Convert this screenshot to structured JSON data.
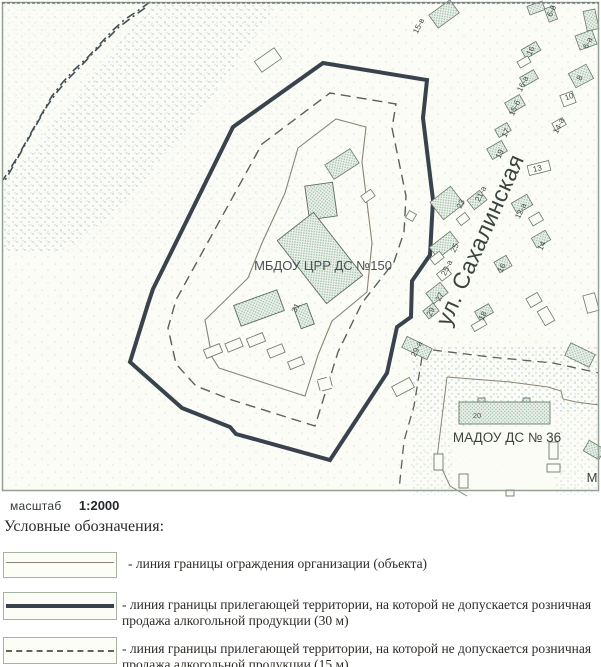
{
  "map": {
    "main_object_label": "МБДОУ ЦРР ДС №150",
    "main_building_number": "31",
    "street_name": "ул. Сахалинская",
    "secondary_object_label": "МАДОУ ДС № 36",
    "secondary_building_number": "20",
    "edge_letter": "М",
    "building_labels": {
      "n15v": "15-в",
      "n6b": "6-б",
      "n6a": "6-а",
      "n16n": "16",
      "n8": "8",
      "n16a": "16-а",
      "n15b": "15-б",
      "n10": "10",
      "n14a": "14-а",
      "n17": "17",
      "n19": "19",
      "n13": "13",
      "n21a": "21-а",
      "n23": "23",
      "n12a": "12-а",
      "n14": "14",
      "n25": "25",
      "n25a": "25-а",
      "n16s": "16",
      "n27": "27",
      "n29": "29",
      "n18": "18",
      "n29a": "29-а"
    },
    "colors": {
      "boundary_30m": "#39424d",
      "boundary_15m": "#5c6157",
      "fence": "#8b8474",
      "building_dot": "#9dbfa9",
      "stipple_blue": "#7f9fd2",
      "paper": "#fcfcf6"
    }
  },
  "scale": {
    "label": "масштаб",
    "value": "1:2000"
  },
  "legend": {
    "title": "Условные обозначения:",
    "items": [
      {
        "label": "- линия границы ограждения организации (объекта)"
      },
      {
        "label": "- линия границы прилегающей территории, на которой не допускается розничная продажа алкогольной продукции (30 м)"
      },
      {
        "label": "- линия границы прилегающей территории, на которой не допускается розничная продажа алкогольной продукции (15 м)"
      }
    ]
  }
}
